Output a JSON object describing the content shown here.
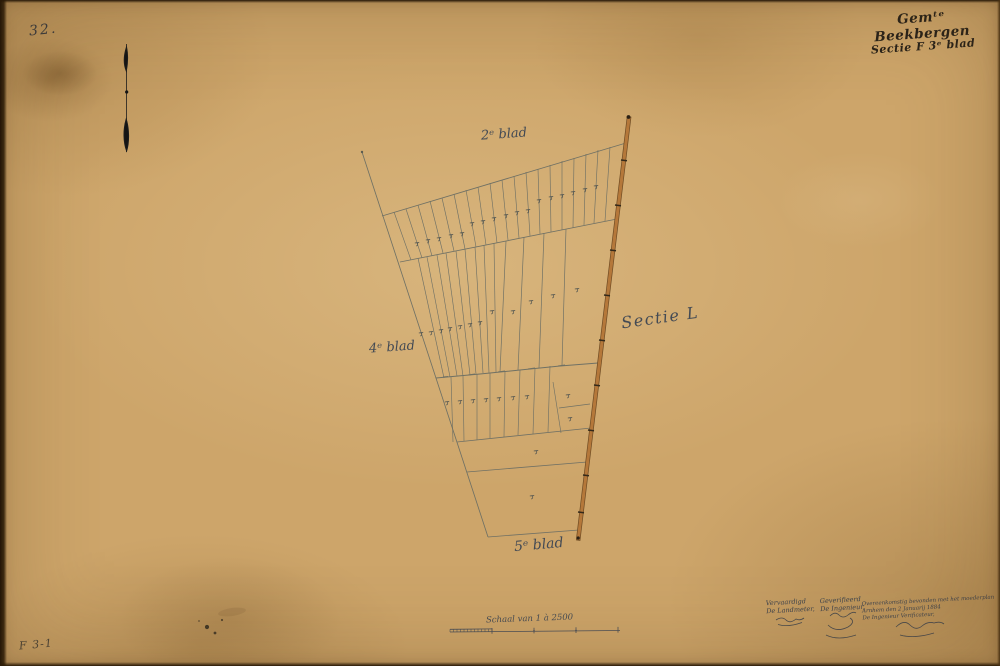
{
  "sheet": {
    "number_annotation": "32.",
    "inventory_code": "F 3-1"
  },
  "title_block": {
    "line1": "Gemᵗᵉ Beekbergen",
    "line2": "Sectie F 3ᵉ blad"
  },
  "map_labels": {
    "adjacent_sheet_top": "2ᵉ blad",
    "adjacent_sheet_left": "4ᵉ blad",
    "adjacent_sheet_bottom": "5ᵉ blad",
    "section_label": "Sectie L"
  },
  "scale_bar": {
    "caption": "Schaal van 1 à 2500"
  },
  "certification": {
    "made_by": {
      "lines": [
        "Vervaardigd",
        "De Landmeter,"
      ]
    },
    "verified_by": {
      "lines": [
        "Geverifieerd",
        "De Ingenieur,"
      ]
    },
    "statement": {
      "lines": [
        "Overeenkomstig bevonden met het moederplan",
        "Arnhem den 2 Januarij 1884",
        "De Ingenieur Verificateur,"
      ]
    }
  },
  "icons": {
    "north_arrow": "north-arrow-icon"
  },
  "colors": {
    "paper": "#cda56a",
    "ink": "#565b55",
    "road_fill": "#b5783a",
    "title_ink": "#28221a"
  }
}
